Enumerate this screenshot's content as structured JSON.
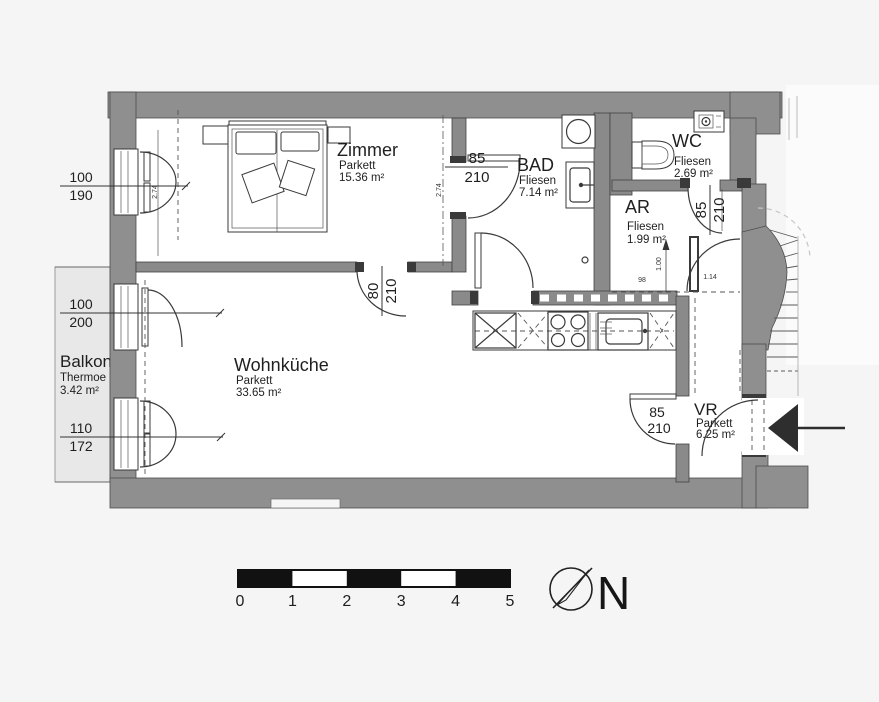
{
  "rooms": {
    "zimmer": {
      "name": "Zimmer",
      "floor": "Parkett",
      "area": "15.36 m²"
    },
    "bad": {
      "name": "BAD",
      "floor": "Fliesen",
      "area": "7.14 m²"
    },
    "wc": {
      "name": "WC",
      "floor": "Fliesen",
      "area": "2.69 m²"
    },
    "ar": {
      "name": "AR",
      "floor": "Fliesen",
      "area": "1.99 m²"
    },
    "wohnkueche": {
      "name": "Wohnküche",
      "floor": "Parkett",
      "area": "33.65 m²"
    },
    "vr": {
      "name": "VR",
      "floor": "Parkett",
      "area": "6.25 m²"
    },
    "balkon": {
      "name": "Balkon",
      "floor": "Thermoe",
      "area": "3.42 m²"
    }
  },
  "dimensions": {
    "zimmer_window": {
      "top": "100",
      "bottom": "190"
    },
    "balcony_door": {
      "top": "100",
      "bottom": "200"
    },
    "wohnkueche_window": {
      "top": "110",
      "bottom": "172"
    },
    "zimmer_bad_door": {
      "top": "85",
      "bottom": "210"
    },
    "zimmer_wohnkueche_door": {
      "top": "80",
      "bottom": "210"
    },
    "wc_door": {
      "top": "85",
      "bottom": "210"
    },
    "vr_door": {
      "top": "85",
      "bottom": "210"
    },
    "zimmer_width_left": "2.74",
    "zimmer_width_right": "2.74",
    "ar_dim_a": "1.00",
    "ar_dim_b": "98",
    "ar_dim_c": "1.14"
  },
  "scale_bar": {
    "ticks": [
      "0",
      "1",
      "2",
      "3",
      "4",
      "5"
    ]
  },
  "compass": {
    "label": "N"
  },
  "colors": {
    "wall": "#8f8f8f",
    "balcony": "#e8e8e8",
    "background": "#f5f5f5",
    "line": "#3a3a3a",
    "entrance_arrow": "#2e2e2e",
    "room_fill": "#ffffff"
  }
}
